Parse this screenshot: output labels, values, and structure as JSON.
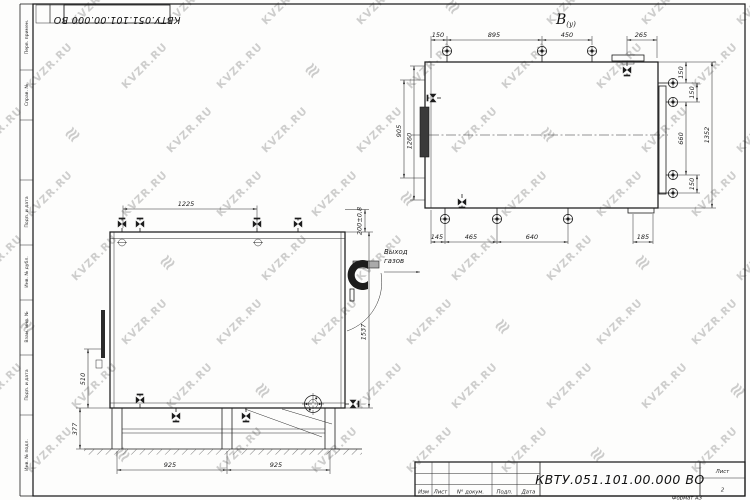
{
  "watermark": {
    "text": "KVZR.RU",
    "icon_glyph": "≋"
  },
  "sheet": {
    "doc_number": "КВТУ.051.101.00.000  ВО",
    "doc_number_flipped": "КВТУ.051.101.00.000  ВО",
    "sheet_label": "Лист",
    "sheet_number": "2",
    "format_note": "Формат  А3",
    "stamp_columns": [
      "Изм",
      "Лист",
      "N° докум.",
      "Подп.",
      "Дата"
    ],
    "margin_labels": [
      "Перв. примен.",
      "Справ. №",
      "Подп. и дата",
      "Инв. № дубл.",
      "Взам. инв. №",
      "Подп. и дата",
      "Инв. № подл."
    ]
  },
  "front_view": {
    "dim_top": "1225",
    "dim_outlet_offset": "200±0,8",
    "dim_height": "1537",
    "dim_left_mid": "510",
    "dim_left_bottom": "377",
    "dim_base": [
      "925",
      "925"
    ],
    "outlet_line1": "Выход",
    "outlet_line2": "газов"
  },
  "plan_view": {
    "view_label": "В",
    "view_label_sub": "(у)",
    "dims_top": [
      "150",
      "895",
      "450",
      "265"
    ],
    "dims_bottom": [
      "145",
      "465",
      "640",
      "185"
    ],
    "dims_left": [
      "905",
      "1260"
    ],
    "dims_right": [
      "150",
      "150",
      "660",
      "150"
    ],
    "dim_overall_right": "1352"
  }
}
